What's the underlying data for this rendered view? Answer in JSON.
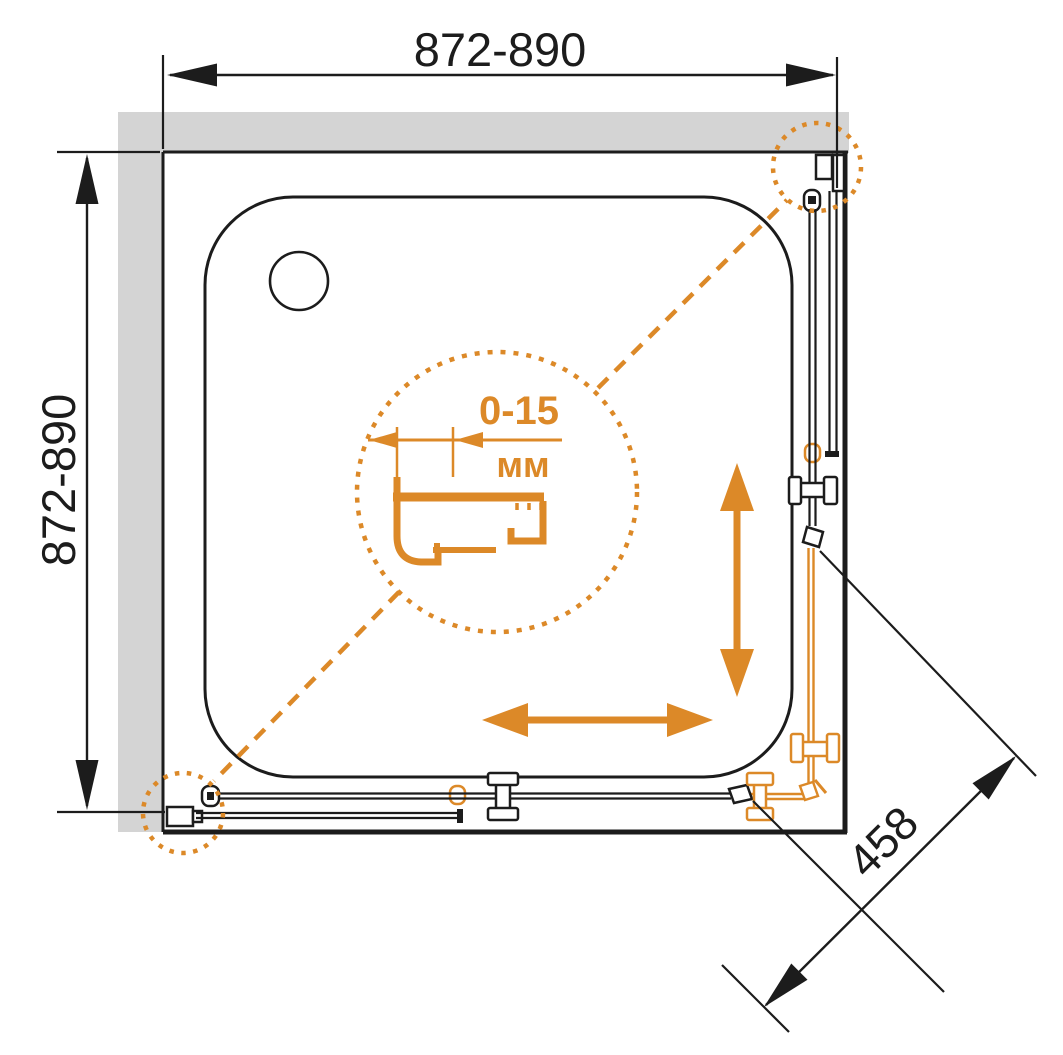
{
  "diagram": {
    "type": "technical-drawing",
    "subject": "corner shower enclosure with sliding doors, plan view",
    "dimensions": {
      "top_width_label": "872-890",
      "left_height_label": "872-890",
      "diagonal_label": "458",
      "detail_range_label": "0-15",
      "detail_unit_label": "мм"
    },
    "colors": {
      "accent_orange": "#DC8928",
      "wall_gray": "#D4D4D4",
      "line_black": "#1C1C1C",
      "background": "#FFFFFF"
    }
  }
}
